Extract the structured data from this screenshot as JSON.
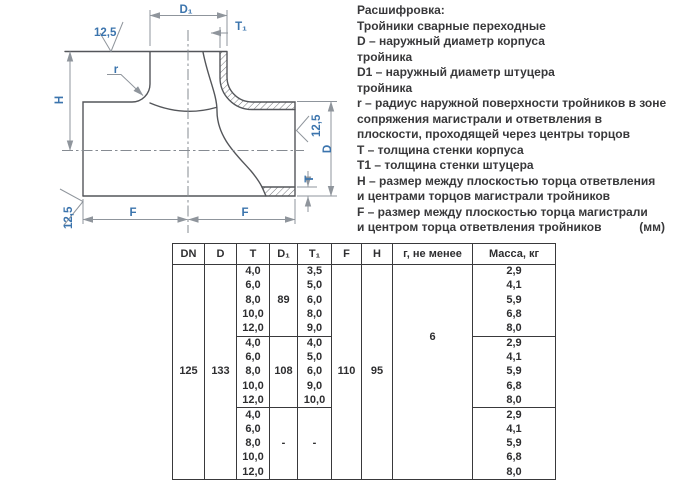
{
  "colors": {
    "accent_blue": "#3b74ad",
    "drawing_line": "#54565a",
    "table_line": "#39393b",
    "text": "#38383a"
  },
  "drawing": {
    "labels": {
      "d1": "D₁",
      "t1": "T₁",
      "r": "r",
      "h": "H",
      "d": "D",
      "t": "T",
      "f": "F",
      "roughness": "12,5"
    }
  },
  "legend": {
    "lines": [
      "Расшифровка:",
      "Тройники сварные переходные",
      "D – наружный диаметр корпуса",
      "тройника",
      "D1 – наружный диаметр штуцера",
      "тройника",
      "r – радиус наружной поверхности тройников в зоне",
      "сопряжения магистрали и ответвления в",
      "плоскости, проходящей через центры торцов",
      "T – толщина стенки корпуса",
      "T1 – толщина стенки штуцера",
      "H – размер между плоскостью торца ответвления",
      "и центрами торцов магистрали тройников",
      "F – размер между плоскостью торца магистрали",
      "и центром торца ответвления тройников"
    ],
    "units_note": "(мм)"
  },
  "table": {
    "headers": [
      "DN",
      "D",
      "T",
      "D₁",
      "T₁",
      "F",
      "H",
      "г, не менее",
      "Масса, кг"
    ],
    "dn": "125",
    "d": "133",
    "f": "110",
    "h": "95",
    "r_min": "6",
    "groups": [
      {
        "d1": "89",
        "rows": [
          [
            "4,0",
            "3,5",
            "2,9"
          ],
          [
            "6,0",
            "5,0",
            "4,1"
          ],
          [
            "8,0",
            "6,0",
            "5,9"
          ],
          [
            "10,0",
            "8,0",
            "6,8"
          ],
          [
            "12,0",
            "9,0",
            "8,0"
          ]
        ]
      },
      {
        "d1": "108",
        "rows": [
          [
            "4,0",
            "4,0",
            "2,9"
          ],
          [
            "6,0",
            "5,0",
            "4,1"
          ],
          [
            "8,0",
            "6,0",
            "5,9"
          ],
          [
            "10,0",
            "9,0",
            "6,8"
          ],
          [
            "12,0",
            "10,0",
            "8,0"
          ]
        ]
      },
      {
        "d1": "-",
        "t1_merged": "-",
        "rows": [
          [
            "4,0",
            "",
            "2,9"
          ],
          [
            "6,0",
            "",
            "4,1"
          ],
          [
            "8,0",
            "",
            "5,9"
          ],
          [
            "10,0",
            "",
            "6,8"
          ],
          [
            "12,0",
            "",
            "8,0"
          ]
        ]
      }
    ]
  }
}
